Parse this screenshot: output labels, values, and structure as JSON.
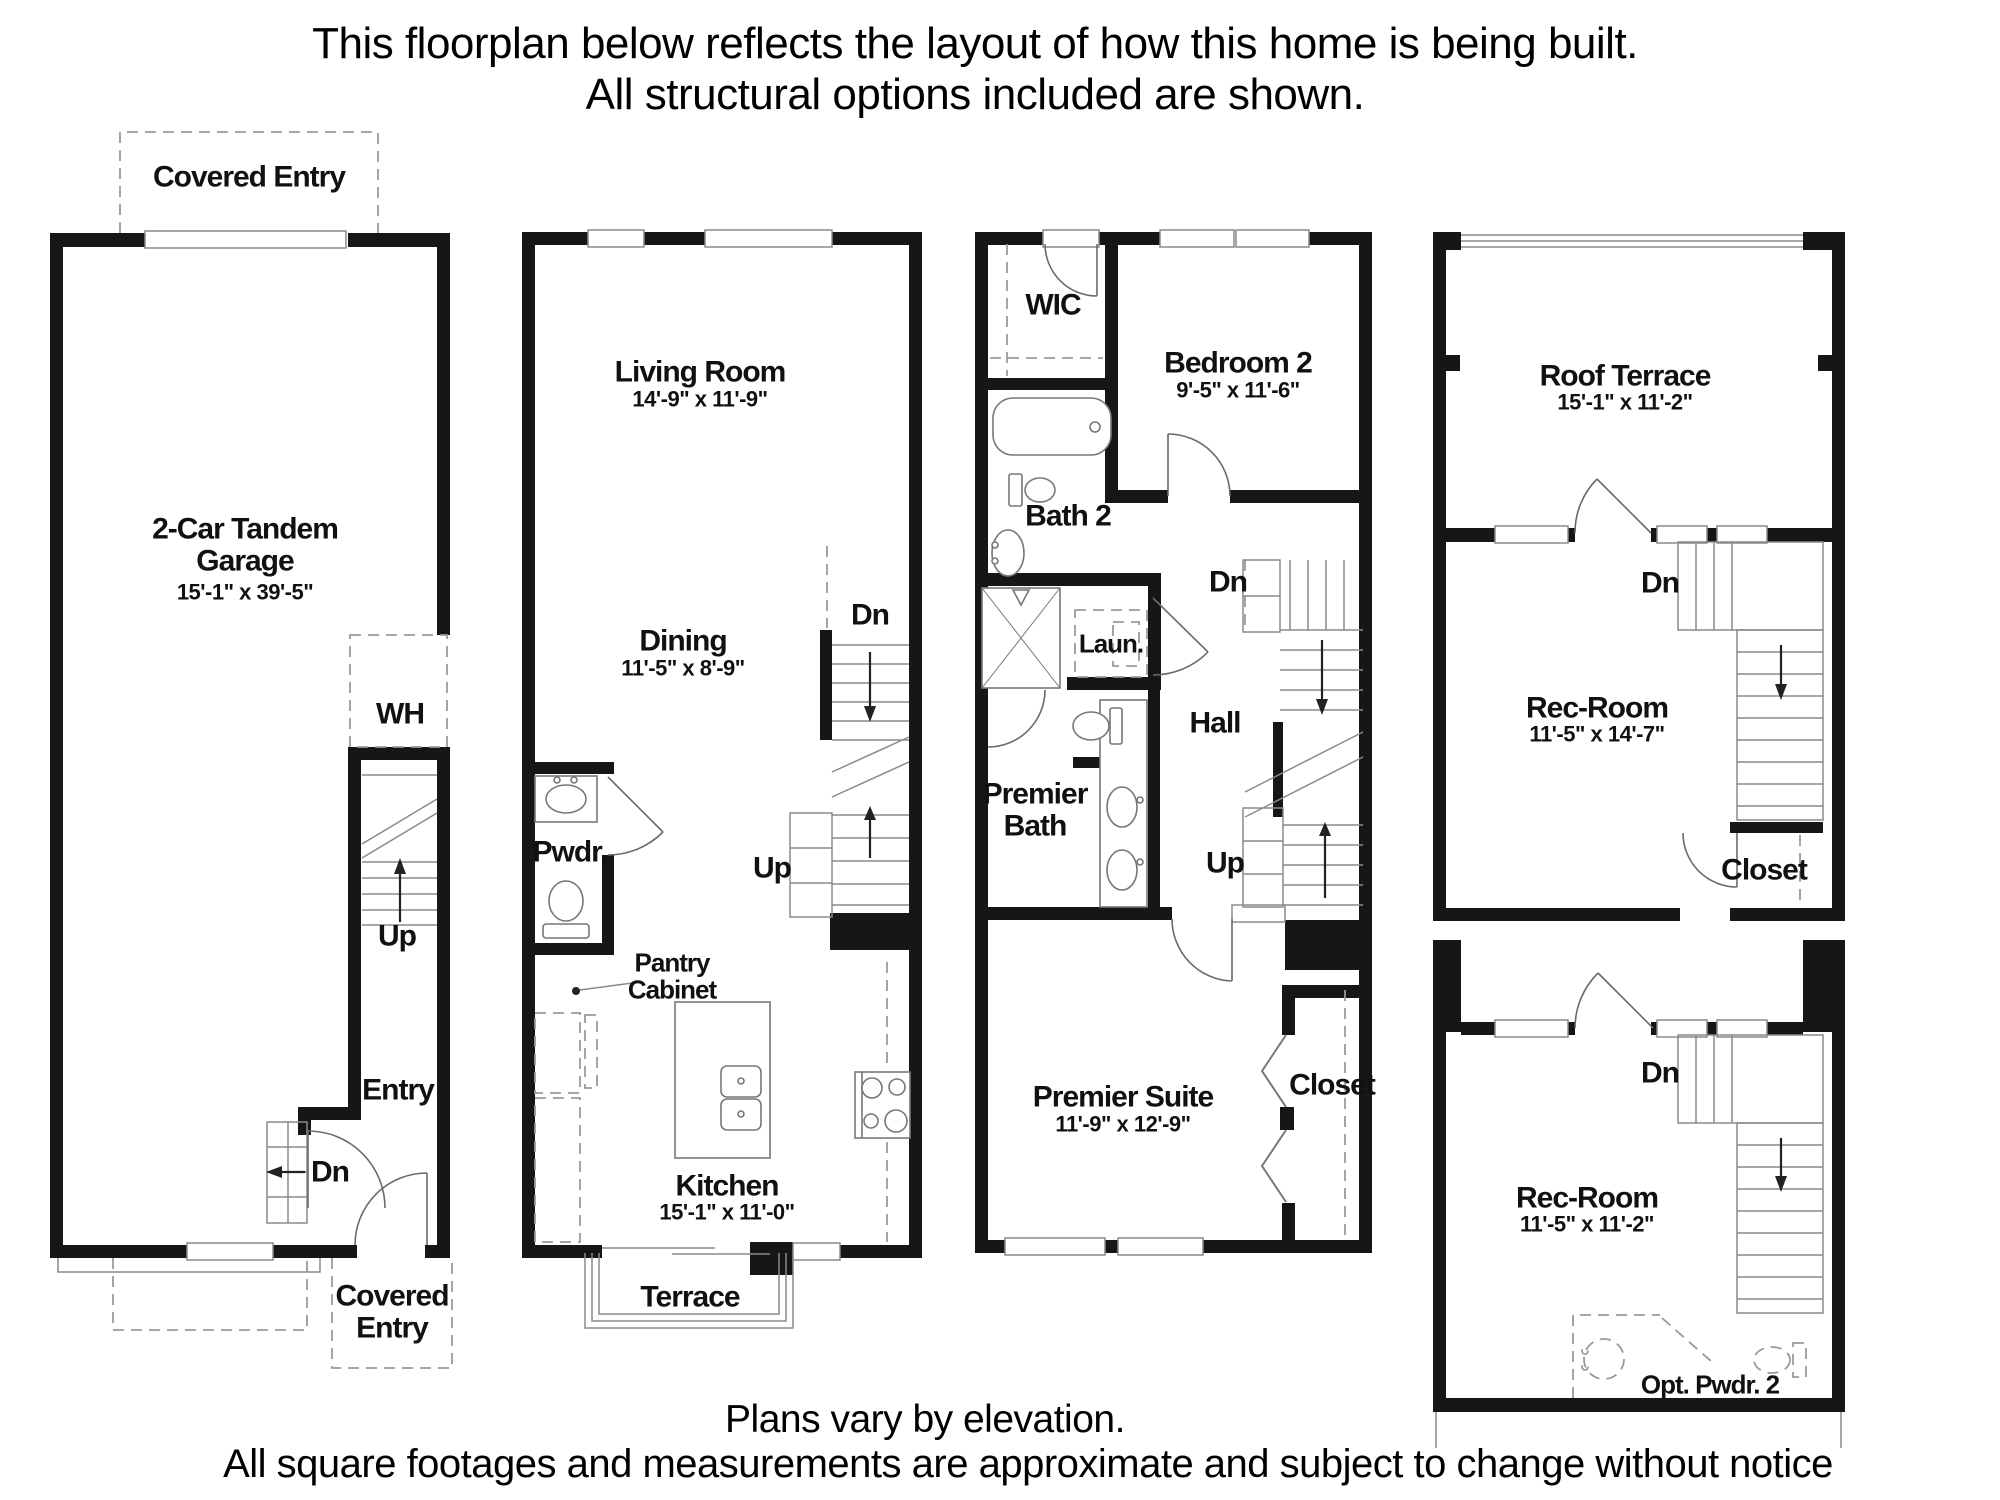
{
  "header": {
    "line1": "This floorplan below reflects the layout of how this home is being built.",
    "line2": "All structural options included are shown."
  },
  "footer": {
    "line1": "Plans vary by elevation.",
    "line2": "All square footages and measurements are approximate and subject to change without notice"
  },
  "floor1": {
    "covered_entry_top": "Covered Entry",
    "garage_name": "2-Car Tandem Garage",
    "garage_dims": "15'-1\" x 39'-5\"",
    "wh": "WH",
    "up": "Up",
    "entry": "Entry",
    "dn": "Dn",
    "covered_entry_bottom": "Covered Entry"
  },
  "floor2": {
    "living_name": "Living Room",
    "living_dims": "14'-9\" x 11'-9\"",
    "dining_name": "Dining",
    "dining_dims": "11'-5\" x 8'-9\"",
    "dn": "Dn",
    "up": "Up",
    "pwdr": "Pwdr.",
    "pantry": "Pantry Cabinet",
    "kitchen_name": "Kitchen",
    "kitchen_dims": "15'-1\" x 11'-0\"",
    "terrace": "Terrace"
  },
  "floor3": {
    "wic": "WIC",
    "bedroom2_name": "Bedroom 2",
    "bedroom2_dims": "9'-5\" x 11'-6\"",
    "bath2": "Bath 2",
    "laun": "Laun.",
    "dn": "Dn",
    "hall": "Hall",
    "premier_bath": "Premier Bath",
    "up": "Up",
    "suite_name": "Premier Suite",
    "suite_dims": "11'-9\" x 12'-9\"",
    "closet": "Closet"
  },
  "floor4": {
    "roof_terrace_name": "Roof Terrace",
    "roof_terrace_dims": "15'-1\" x 11'-2\"",
    "dn_upper": "Dn",
    "rec_upper_name": "Rec-Room",
    "rec_upper_dims": "11'-5\" x 14'-7\"",
    "closet": "Closet",
    "dn_lower": "Dn",
    "rec_lower_name": "Rec-Room",
    "rec_lower_dims": "11'-5\" x 11'-2\"",
    "opt_pwdr": "Opt. Pwdr. 2"
  }
}
